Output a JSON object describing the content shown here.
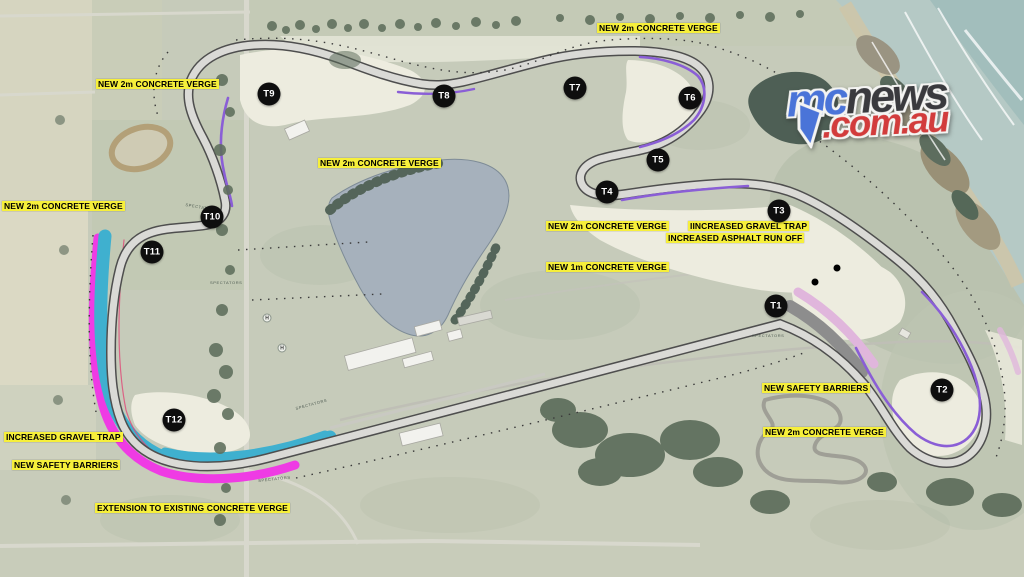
{
  "map": {
    "annotations": [
      {
        "text": "NEW 2m CONCRETE VERGE",
        "x": 597,
        "y": 23
      },
      {
        "text": "NEW 2m CONCRETE VERGE",
        "x": 96,
        "y": 79
      },
      {
        "text": "NEW 2m CONCRETE VERGE",
        "x": 318,
        "y": 158
      },
      {
        "text": "NEW 2m CONCRETE VERGE",
        "x": 2,
        "y": 201
      },
      {
        "text": "NEW 2m CONCRETE VERGE",
        "x": 546,
        "y": 221
      },
      {
        "text": "IINCREASED GRAVEL TRAP",
        "x": 688,
        "y": 221
      },
      {
        "text": "INCREASED ASPHALT RUN OFF",
        "x": 666,
        "y": 233
      },
      {
        "text": "NEW 1m CONCRETE VERGE",
        "x": 546,
        "y": 262
      },
      {
        "text": "NEW SAFETY BARRIERS",
        "x": 762,
        "y": 383
      },
      {
        "text": "NEW 2m CONCRETE VERGE",
        "x": 763,
        "y": 427
      },
      {
        "text": "INCREASED GRAVEL TRAP",
        "x": 4,
        "y": 432
      },
      {
        "text": "NEW SAFETY BARRIERS",
        "x": 12,
        "y": 460
      },
      {
        "text": "EXTENSION TO EXISTING CONCRETE VERGE",
        "x": 95,
        "y": 503
      }
    ],
    "turns": [
      {
        "label": "T1",
        "x": 776,
        "y": 306
      },
      {
        "label": "T2",
        "x": 942,
        "y": 390
      },
      {
        "label": "T3",
        "x": 779,
        "y": 211
      },
      {
        "label": "T4",
        "x": 607,
        "y": 192
      },
      {
        "label": "T5",
        "x": 658,
        "y": 160
      },
      {
        "label": "T6",
        "x": 690,
        "y": 98
      },
      {
        "label": "T7",
        "x": 575,
        "y": 88
      },
      {
        "label": "T8",
        "x": 444,
        "y": 96
      },
      {
        "label": "T9",
        "x": 269,
        "y": 94
      },
      {
        "label": "T10",
        "x": 212,
        "y": 217
      },
      {
        "label": "T11",
        "x": 152,
        "y": 252
      },
      {
        "label": "T12",
        "x": 174,
        "y": 420
      }
    ],
    "spectator_labels": [
      {
        "text": "SPECTATORS",
        "x": 752,
        "y": 333,
        "rot": 0
      },
      {
        "text": "SPECTATORS",
        "x": 186,
        "y": 202,
        "rot": 10
      },
      {
        "text": "SPECTATORS",
        "x": 210,
        "y": 280,
        "rot": 0
      },
      {
        "text": "SPECTATORS",
        "x": 258,
        "y": 478,
        "rot": -6
      },
      {
        "text": "SPECTATORS",
        "x": 295,
        "y": 406,
        "rot": -15
      }
    ],
    "helipads": [
      {
        "text": "H",
        "x": 267,
        "y": 318
      },
      {
        "text": "H",
        "x": 282,
        "y": 348
      }
    ]
  },
  "logo": {
    "mc": "mc",
    "news": "news",
    "domain": ".com.au"
  },
  "colors": {
    "label_bg": "#f6ef3b",
    "label_text": "#000000",
    "turn_bg": "#0e0e0e",
    "turn_text": "#ffffff",
    "verge_purple": "#8a5ed6",
    "runoff_cyan": "#3fb0cf",
    "barrier_magenta": "#ef3be4",
    "gravel_gray": "#8d8d8d",
    "asphalt_pink": "#e0b6dc",
    "logo_blue": "#4a74d8",
    "logo_dark": "#3a3a3e",
    "logo_red": "#d23c3c"
  }
}
